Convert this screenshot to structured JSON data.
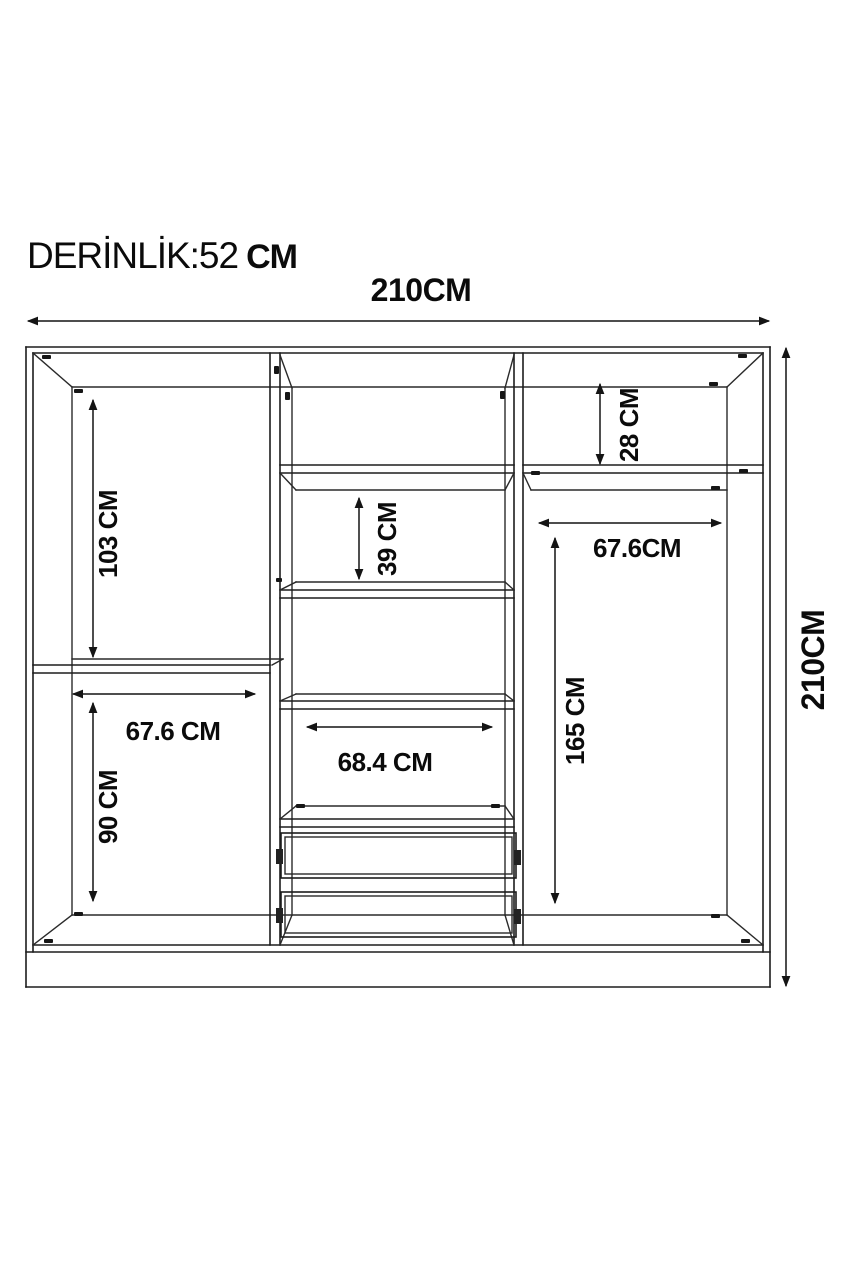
{
  "drawing": {
    "depth_text": "DERİNLİK:52",
    "depth_unit": "CM",
    "overall_width": "210CM",
    "overall_height": "210CM"
  },
  "dimensions": {
    "left_top_height": "103 CM",
    "left_bottom_width": "67.6 CM",
    "left_bottom_height": "90 CM",
    "center_shelf_gap": "39 CM",
    "center_width": "68.4 CM",
    "right_top_height": "28 CM",
    "right_width": "67.6CM",
    "right_height": "165 CM"
  },
  "style": {
    "line_color": "#1d1d1d",
    "text_color": "#0b0b0b",
    "background": "#ffffff"
  }
}
